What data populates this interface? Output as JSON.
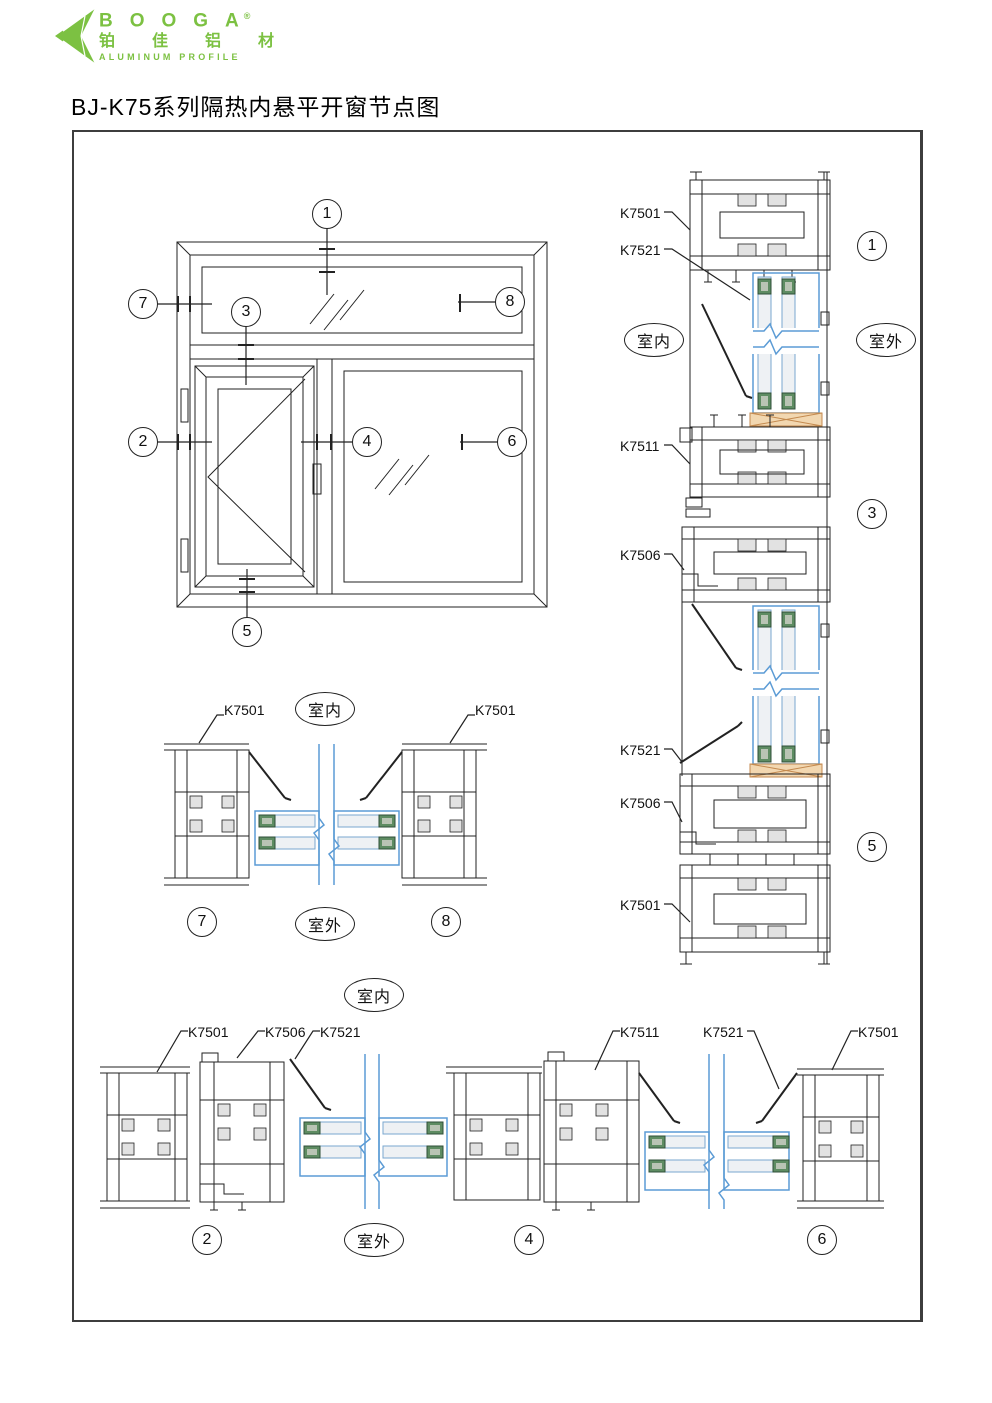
{
  "logo": {
    "brand": "BOOGA",
    "reg": "®",
    "cn": "铂佳铝材",
    "en": "ALUMINUM PROFILE"
  },
  "title": "BJ-K75系列隔热内悬平开窗节点图",
  "terms": {
    "indoor": "室内",
    "outdoor": "室外"
  },
  "elevation": {
    "callouts": [
      "1",
      "2",
      "3",
      "4",
      "5",
      "6",
      "7",
      "8"
    ]
  },
  "vertical_section": {
    "callouts": [
      "1",
      "3",
      "5"
    ],
    "labels": [
      "K7501",
      "K7521",
      "K7511",
      "K7506",
      "K7521",
      "K7506",
      "K7501"
    ]
  },
  "mid_section": {
    "callouts": [
      "7",
      "8"
    ],
    "labels": [
      "K7501",
      "K7501"
    ]
  },
  "bottom_section": {
    "callouts": [
      "2",
      "4",
      "6"
    ],
    "labels": [
      "K7501",
      "K7506",
      "K7521",
      "K7511",
      "K7521",
      "K7501"
    ]
  },
  "colors": {
    "logo_green": "#7CC142",
    "glass_blue": "#5B9BD5",
    "spacer_green": "#5E8C62",
    "shim_tan": "#F2D7B0",
    "line": "#222222"
  }
}
